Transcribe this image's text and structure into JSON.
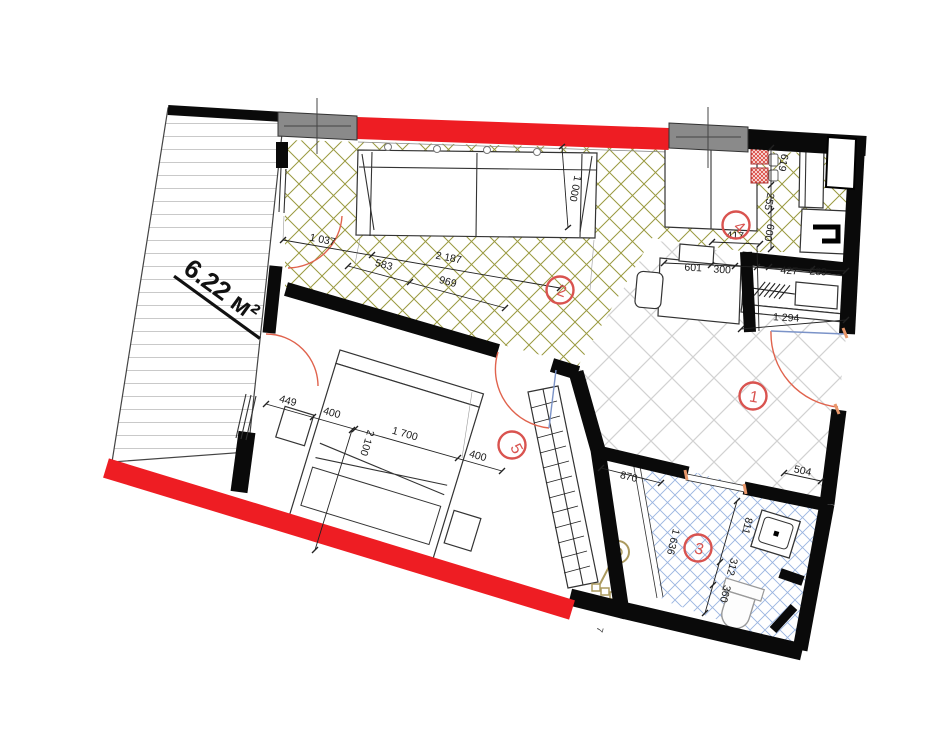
{
  "drawing_type": "apartment-floor-plan",
  "labels": {
    "area": "6.22 м²",
    "stray": "7",
    "rooms": [
      "1",
      "2",
      "3",
      "4",
      "5"
    ]
  },
  "dims": {
    "living": [
      "1 037",
      "2 187",
      "583",
      "969",
      "1 000"
    ],
    "kitchen": [
      "601",
      "300",
      "417",
      "255",
      "427",
      "289",
      "619",
      "600"
    ],
    "hall": [
      "1 294",
      "504"
    ],
    "bedroom": [
      "449",
      "400",
      "1 700",
      "400",
      "2 100"
    ],
    "bath": [
      "870",
      "1 636",
      "811",
      "312",
      "360"
    ]
  },
  "colors": {
    "exterior_wall_red": "#ee1d23",
    "structural_column_gray": "#8a8a8a",
    "interior_wall_black": "#0a0a0a",
    "living_floor_hatch_olive": "#9a9a40",
    "hall_floor_hatch_gray": "#d2d2d2",
    "bath_floor_hatch_blue": "#9ab4e0",
    "door_swing_arc": "#e0634d",
    "door_leaf_blue": "#7b93c8",
    "room_number_red": "#d9534f",
    "stove_burner_red": "#d9453c",
    "plumbing_fixture_tan": "#ab9a5e",
    "balcony_deck_line": "#c9c9c9"
  },
  "icons": {
    "column_center_cross": "crosshair-lines",
    "wardrobe_hatch": "slash-marks",
    "stove_burner": "crosshatched-square",
    "floor_drain_mixer": "circle-with-stem"
  }
}
